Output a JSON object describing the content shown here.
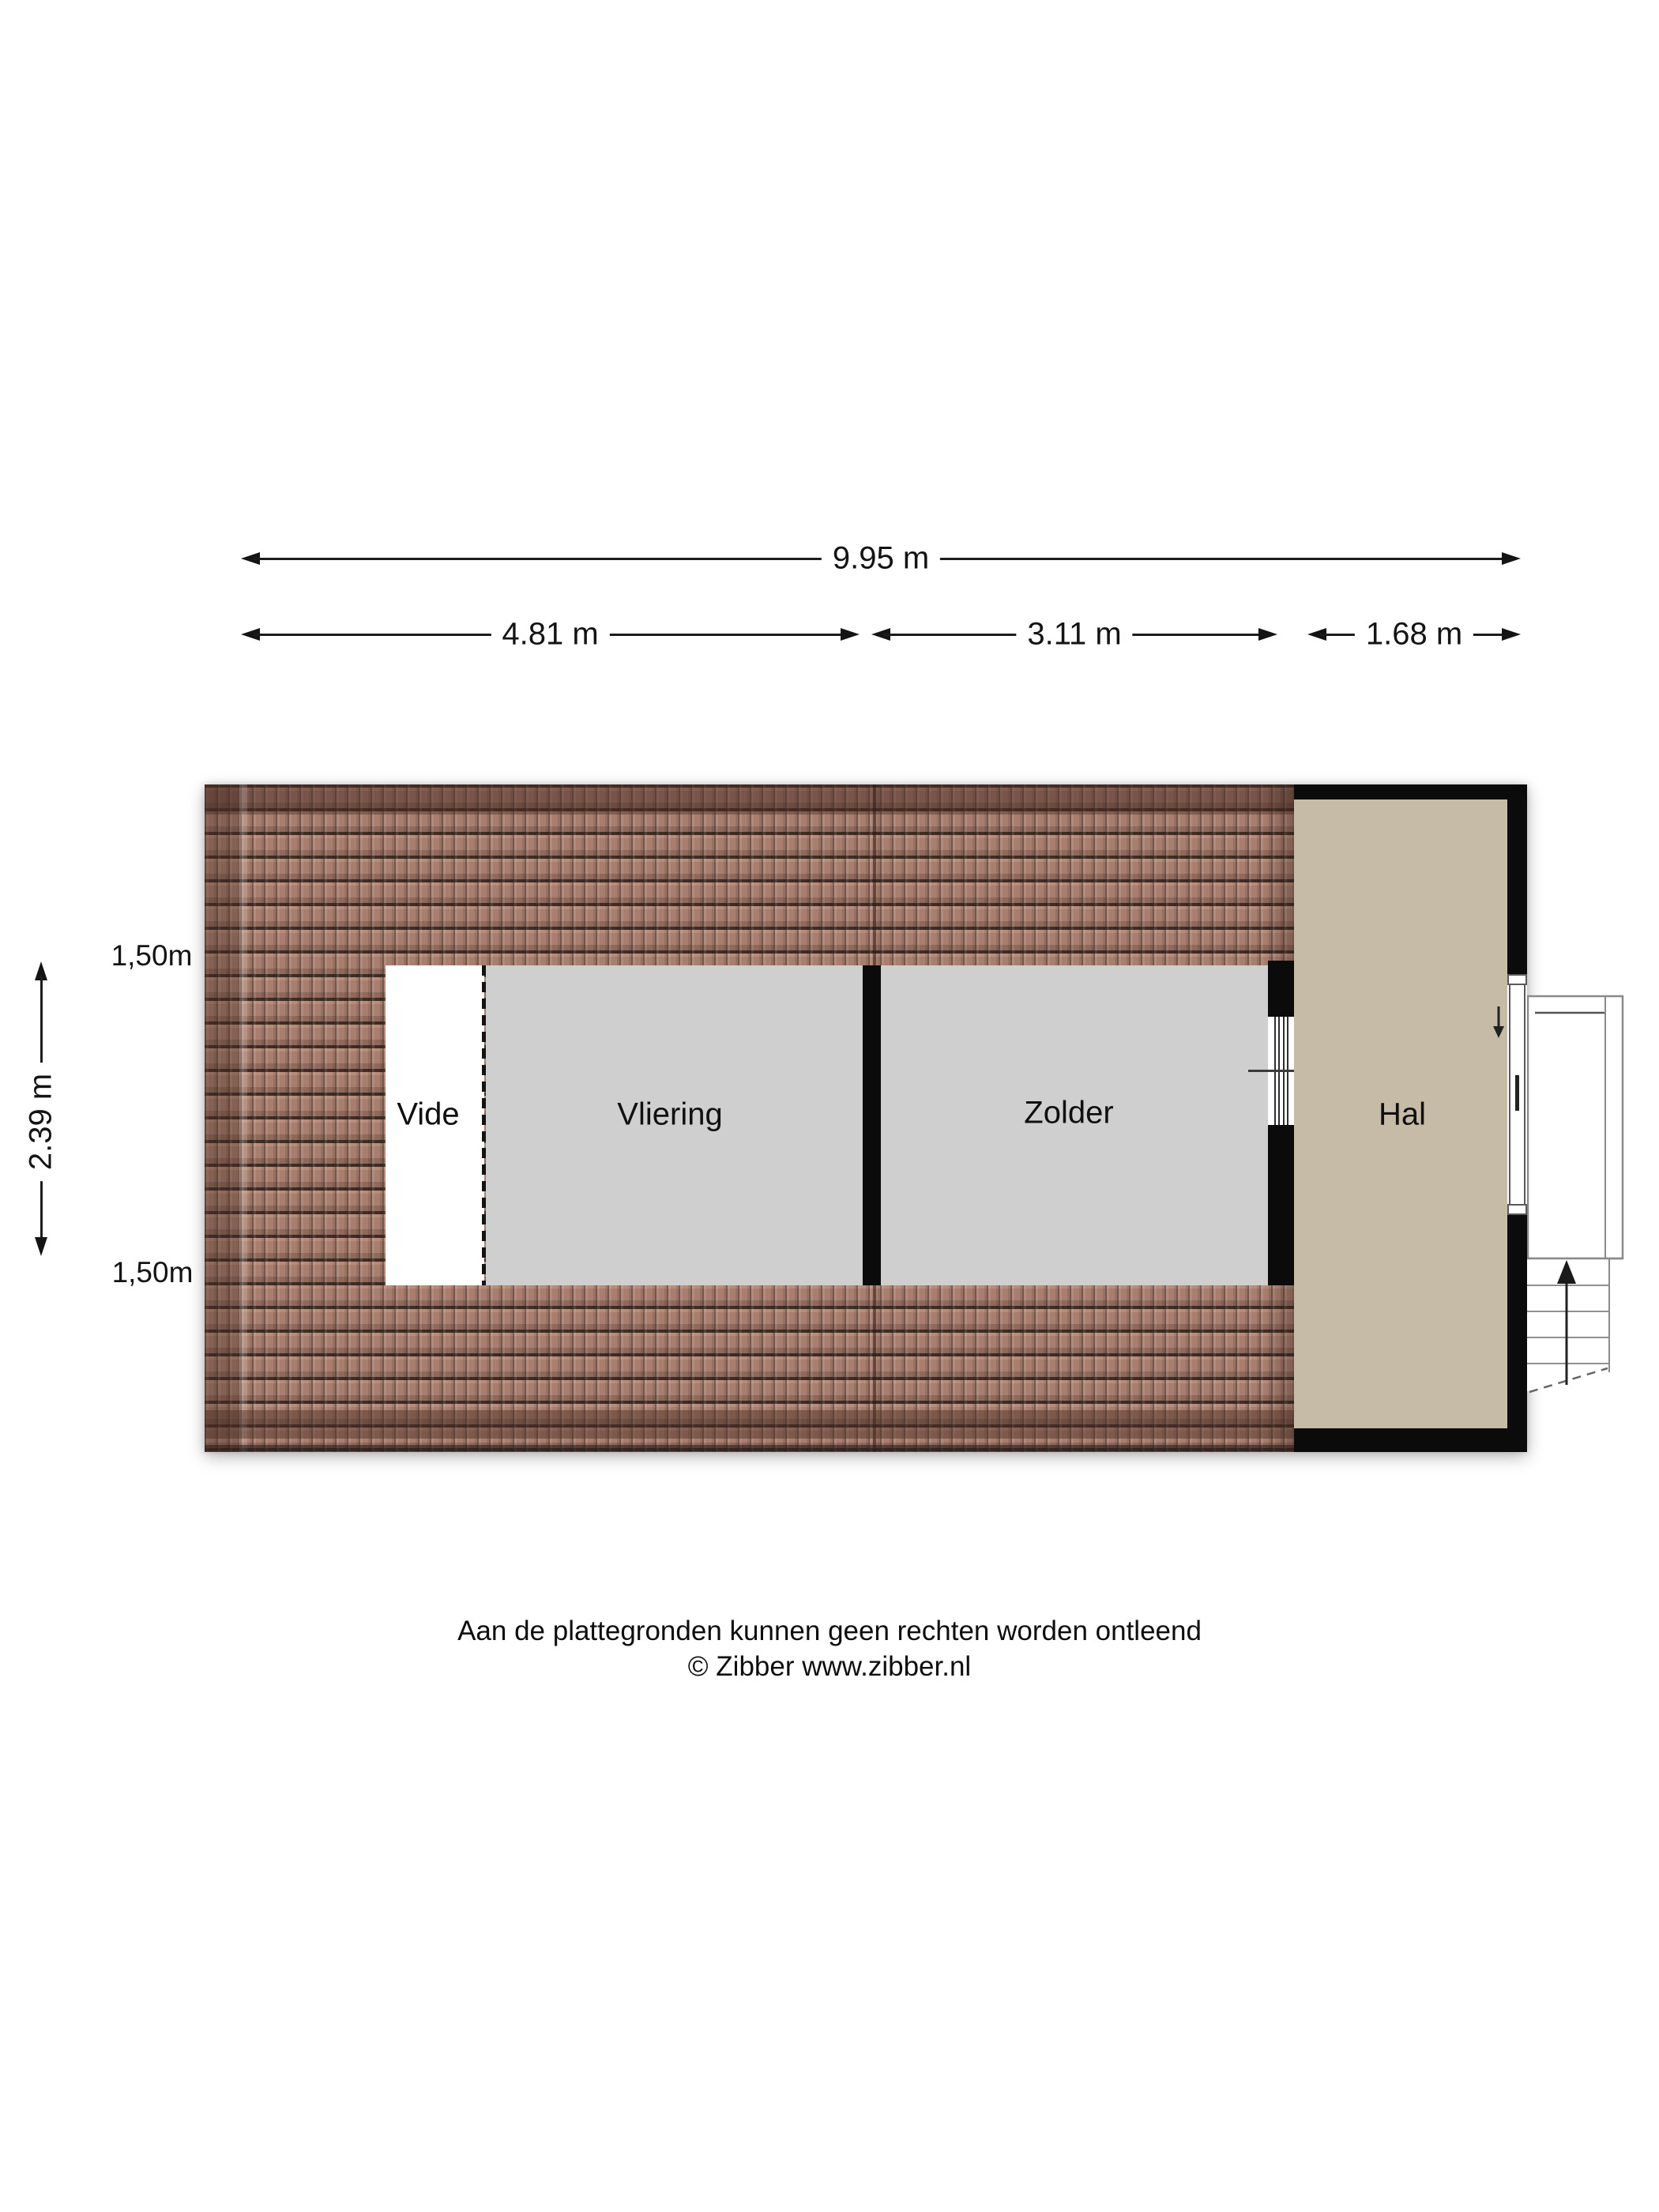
{
  "dimensions": {
    "total_width_label": "9.95 m",
    "segment_labels": [
      "4.81 m",
      "3.11 m",
      "1.68 m"
    ],
    "height_label": "2.39 m",
    "roof_marker_top": "1,50m",
    "roof_marker_bottom": "1,50m"
  },
  "rooms": [
    {
      "name": "Vide"
    },
    {
      "name": "Vliering"
    },
    {
      "name": "Zolder"
    },
    {
      "name": "Hal"
    }
  ],
  "footer": {
    "disclaimer": "Aan de plattegronden kunnen geen rechten worden ontleend",
    "credit": "© Zibber www.zibber.nl"
  },
  "colors": {
    "roof_tile": "#a87e6e",
    "roof_line_dark": "#3f2c25",
    "room_gray": "#cfcfcf",
    "hall_beige": "#c6bba7",
    "wall_black": "#0b0b0b",
    "vide_white": "#ffffff"
  },
  "icons": {
    "hall_arrow": "down-arrow",
    "landing_arrow": "up-arrow",
    "stairs_arrow": "up-arrow"
  }
}
